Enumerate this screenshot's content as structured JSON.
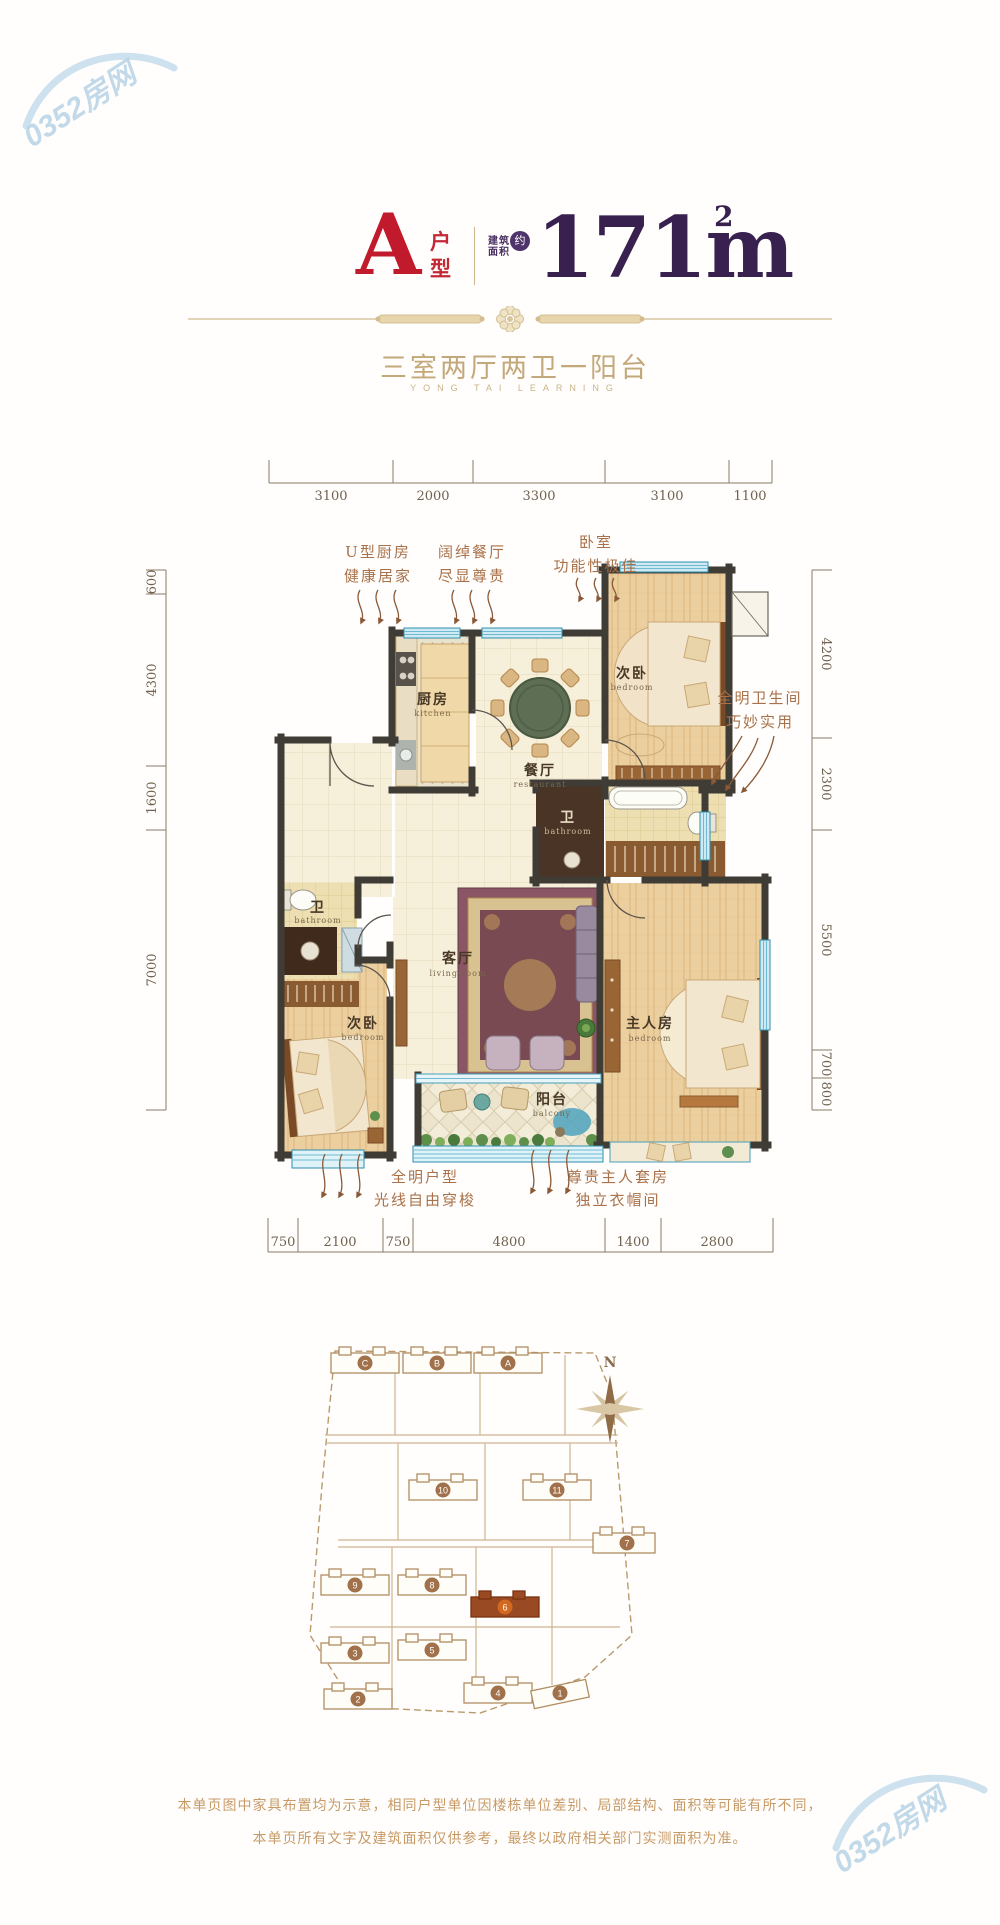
{
  "watermark": {
    "text": "0352房网"
  },
  "header": {
    "type_letter": "A",
    "type_label_1": "户",
    "type_label_2": "型",
    "area_label_1": "建筑",
    "area_label_2": "面积",
    "area_circle": "约",
    "area_value": "171m",
    "area_sup": "2"
  },
  "subtitle": {
    "cn": "三室两厅两卫一阳台",
    "en": "YONG TAI LEARNING"
  },
  "plan": {
    "dims": {
      "top": [
        "3100",
        "2000",
        "3300",
        "3100",
        "1100"
      ],
      "bottom": [
        "750",
        "2100",
        "750",
        "4800",
        "1400",
        "2800"
      ],
      "left": [
        "600",
        "4300",
        "1600",
        "7000"
      ],
      "right": [
        "4200",
        "2300",
        "5500",
        "700",
        "800"
      ]
    },
    "rooms": {
      "kitchen": {
        "cn": "厨房",
        "en": "kitchen"
      },
      "dining": {
        "cn": "餐厅",
        "en": "restaurant"
      },
      "bedroom_top": {
        "cn": "次卧",
        "en": "bedroom"
      },
      "bath_right": {
        "cn": "卫",
        "en": "bathroom"
      },
      "living": {
        "cn": "客厅",
        "en": "living room"
      },
      "master": {
        "cn": "主人房",
        "en": "bedroom"
      },
      "bedroom_left": {
        "cn": "次卧",
        "en": "bedroom"
      },
      "bath_left": {
        "cn": "卫",
        "en": "bathroom"
      },
      "balcony": {
        "cn": "阳台",
        "en": "balcony"
      }
    },
    "notes": {
      "kitchen": [
        "U型厨房",
        "健康居家"
      ],
      "dining": [
        "阔绰餐厅",
        "尽显尊贵"
      ],
      "bedroom": [
        "卧室",
        "功能性极佳"
      ],
      "bath": [
        "全明卫生间",
        "巧妙实用"
      ],
      "daylight": [
        "全明户型",
        "光线自由穿梭"
      ],
      "master": [
        "尊贵主人套房",
        "独立衣帽间"
      ]
    }
  },
  "siteplan": {
    "compass": "N",
    "buildings": [
      {
        "label": "C"
      },
      {
        "label": "B"
      },
      {
        "label": "A"
      },
      {
        "label": "10"
      },
      {
        "label": "11"
      },
      {
        "label": "7"
      },
      {
        "label": "9"
      },
      {
        "label": "8"
      },
      {
        "label": "6",
        "highlight": true
      },
      {
        "label": "3"
      },
      {
        "label": "5"
      },
      {
        "label": "2"
      },
      {
        "label": "4"
      },
      {
        "label": "1"
      }
    ]
  },
  "disclaimer": [
    "本单页图中家具布置均为示意，相同户型单位因楼栋单位差别、局部结构、面积等可能有所不同，",
    "本单页所有文字及建筑面积仅供参考，最终以政府相关部门实测面积为准。"
  ]
}
